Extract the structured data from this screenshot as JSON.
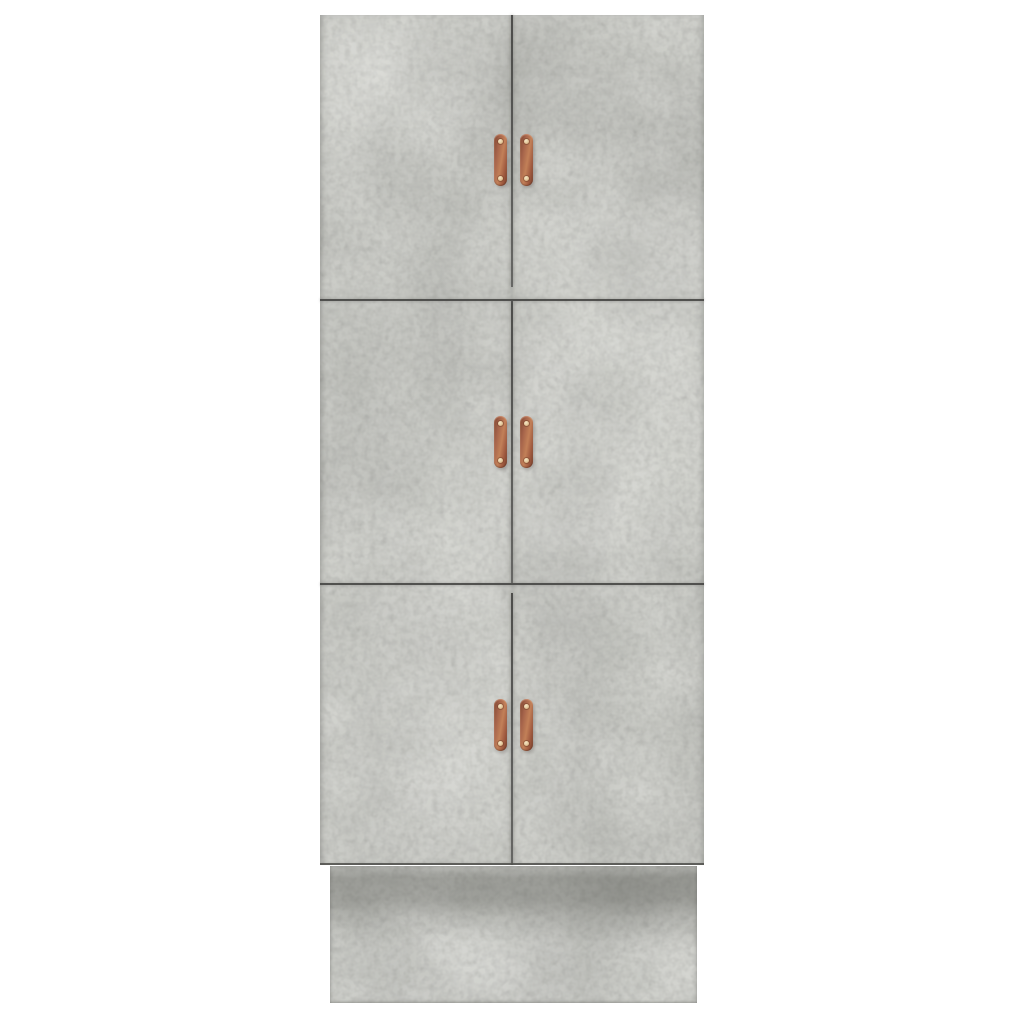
{
  "scene": {
    "type": "product-photo",
    "background_color": "#ffffff",
    "description": "Tall concrete-grey cabinet with six doors, copper handles and a plinth base, shown front-on against a white background"
  },
  "cabinet": {
    "finish": "concrete grey",
    "body_color": "#cfd0cb",
    "body_color_light": "#dcddd9",
    "body_color_dark": "#b6b7b3",
    "seam_color": "#4a4a48",
    "rows": 3,
    "doors_per_row": 2,
    "door_count": 6,
    "door_labels": [
      "door top-left",
      "door top-right",
      "door middle-left",
      "door middle-right",
      "door bottom-left",
      "door bottom-right"
    ],
    "handles": {
      "label": "copper door handle",
      "count": 6,
      "color": "#a5634a",
      "color_light": "#c28058",
      "color_dark": "#7c432e",
      "screw_color": "#eedcb6",
      "screws_per_handle": 2
    },
    "plinth": {
      "label": "plinth base",
      "color": "#c8c9c4",
      "shadow_color": "#54554f"
    }
  }
}
